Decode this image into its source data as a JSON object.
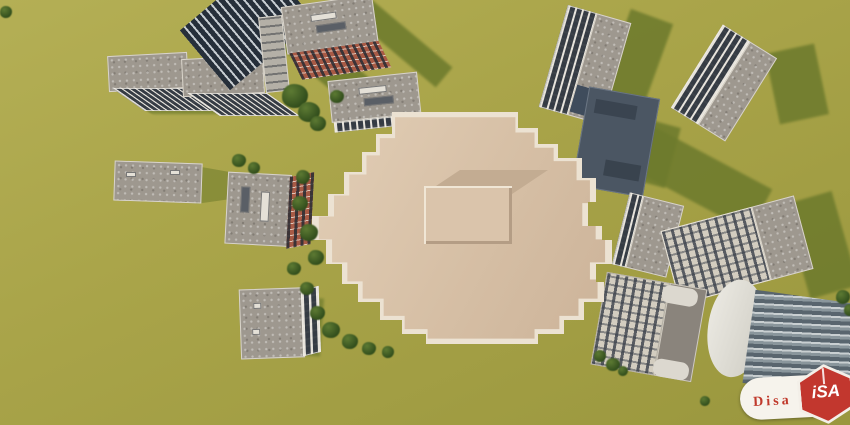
{
  "scene": {
    "type": "3d-architectural-render",
    "view": "aerial-top-down",
    "description": "Large beige cross-shaped building with central rooftop penthouse, surrounded by smaller apartment blocks, a glass high-rise tower and trees on olive-green grass",
    "colors": {
      "grass": "#a9a449",
      "grass_shadow": "#6e7b2d",
      "main_roof": "#d6bfa5",
      "main_parapet": "#ece2d2",
      "gray_roof": "#9e988f",
      "facade_dark": "#454c56",
      "facade_light": "#d3cdc0",
      "brick": "#a85a45",
      "navy_building": "#4b5663",
      "tower_glass": "#262f3a",
      "tree": "#3c5a22",
      "logo_red": "#c2372e"
    },
    "elements": [
      "main-building",
      "rooftop-penthouse",
      "glass-tower",
      "brick-building",
      "white-slab-blocks",
      "navy-roof-building",
      "office-block",
      "curved-glass-building",
      "trees",
      "cast-shadows"
    ]
  },
  "watermark": {
    "brand_persian": "دیـــسا",
    "brand_latin": "Disa",
    "small_text": "مگ",
    "logo_letters": "iSA"
  }
}
